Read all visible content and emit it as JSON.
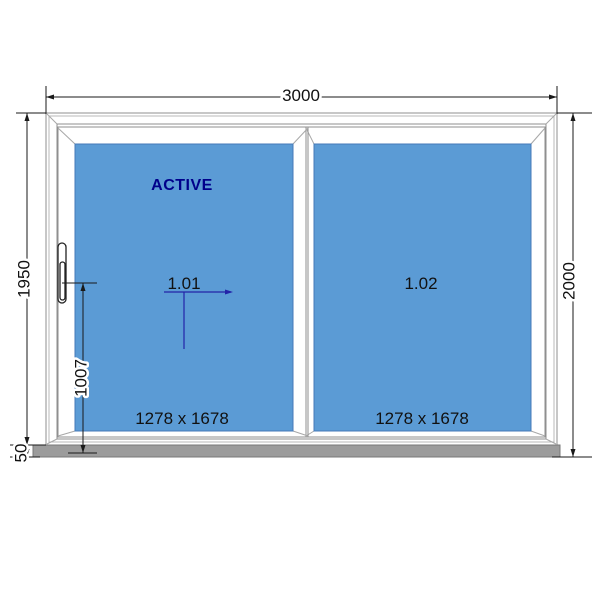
{
  "dimensions": {
    "overall_width": "3000",
    "frame_height": "1950",
    "sill_height": "50",
    "overall_height": "2000",
    "handle_height": "1007"
  },
  "panels": [
    {
      "status": "ACTIVE",
      "ref": "1.01",
      "size": "1278 x 1678"
    },
    {
      "ref": "1.02",
      "size": "1278 x 1678"
    }
  ],
  "colors": {
    "glass": "#5b9bd5",
    "accent": "#00008b",
    "leader": "#2323a8",
    "sill": "#9c9c9c"
  }
}
